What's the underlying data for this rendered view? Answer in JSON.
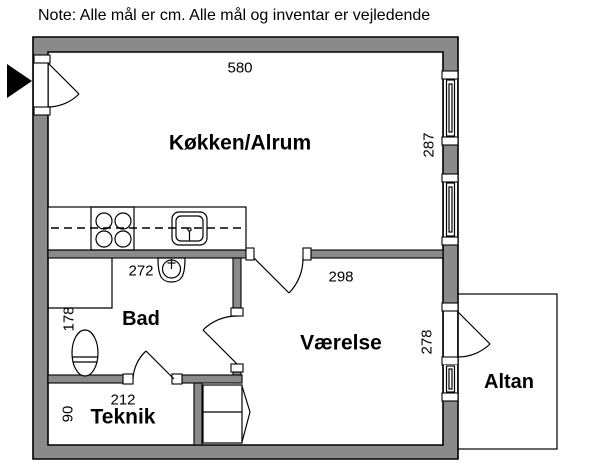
{
  "note": "Note: Alle mål er cm. Alle mål og inventar er vejledende",
  "rooms": {
    "kitchen": {
      "label": "Køkken/Alrum",
      "width_cm": "580",
      "height_cm": "287"
    },
    "bath": {
      "label": "Bad",
      "width_cm": "272",
      "height_cm": "178"
    },
    "bedroom": {
      "label": "Værelse",
      "width_cm": "298",
      "height_cm": "278"
    },
    "tech": {
      "label": "Teknik",
      "width_cm": "212",
      "height_cm": "90"
    },
    "balcony": {
      "label": "Altan"
    }
  },
  "fixtures": [
    "entrance-arrow",
    "entrance-door",
    "kitchen-counter",
    "stove",
    "kitchen-sink",
    "washbasin",
    "toilet",
    "shower",
    "wardrobe",
    "interior-doors",
    "windows",
    "balcony-door",
    "balcony-window"
  ],
  "colors": {
    "wall_fill": "#8a8a8a",
    "line": "#000000",
    "background": "#ffffff"
  }
}
